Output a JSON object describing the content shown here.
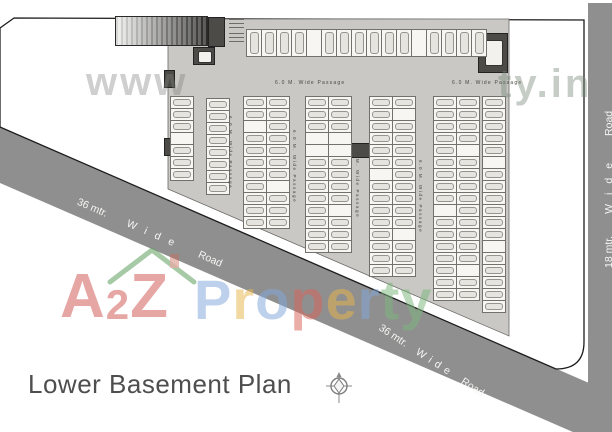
{
  "meta": {
    "plan_title": "Lower Basement Plan"
  },
  "watermarks": {
    "url_prefix": "www",
    "url_suffix": "ty.in",
    "brand": {
      "a2z": [
        {
          "ch": "A",
          "color": "#d15552",
          "size": "big"
        },
        {
          "ch": "2",
          "color": "#d15552",
          "size": "small"
        },
        {
          "ch": "Z",
          "color": "#d15552",
          "size": "big"
        }
      ],
      "property": [
        {
          "ch": "P",
          "color": "#84a9dc"
        },
        {
          "ch": "r",
          "color": "#e8b64c"
        },
        {
          "ch": "o",
          "color": "#84a9dc"
        },
        {
          "ch": "p",
          "color": "#d96459"
        },
        {
          "ch": "e",
          "color": "#e8b64c"
        },
        {
          "ch": "r",
          "color": "#84a9dc"
        },
        {
          "ch": "t",
          "color": "#7cb87c"
        },
        {
          "ch": "y",
          "color": "#7cb87c"
        }
      ]
    }
  },
  "roads": {
    "color": "#8f8f8f",
    "diagonal": {
      "label": {
        "dim": "36 mtr.",
        "wide": "Wide",
        "road": "Road"
      }
    },
    "right": {
      "label": {
        "dim": "18 mtr.",
        "wide": "Wide",
        "road": "Road"
      }
    }
  },
  "plan": {
    "fill": "#c9c8c4",
    "passages_top": [
      {
        "x": 275,
        "y": 80,
        "text": "6.0 M. Wide Passage"
      },
      {
        "x": 452,
        "y": 80,
        "text": "6.0 M. Wide Passage"
      }
    ],
    "passages_vertical": [
      {
        "x": 233,
        "y": 116,
        "text": "6.0 M. Wide Passage"
      },
      {
        "x": 297,
        "y": 130,
        "text": "6.0 M. Wide Passage"
      },
      {
        "x": 360,
        "y": 145,
        "text": "6.0 M. Wide Passage"
      },
      {
        "x": 423,
        "y": 160,
        "text": "6.0 M. Wide Passage"
      }
    ],
    "structures": [
      {
        "name": "entry-ramp",
        "type": "ramp",
        "x": 115,
        "y": 16,
        "w": 93,
        "h": 30
      },
      {
        "name": "core-block",
        "type": "solid",
        "x": 208,
        "y": 17,
        "w": 17,
        "h": 30
      },
      {
        "name": "ramp-note-1",
        "type": "notes",
        "x": 229,
        "y": 19,
        "w": 15,
        "h": 10
      },
      {
        "name": "ramp-note-2",
        "type": "notes",
        "x": 229,
        "y": 33,
        "w": 15,
        "h": 10
      },
      {
        "name": "lift-top-left",
        "type": "lift",
        "x": 193,
        "y": 47,
        "w": 22,
        "h": 18
      },
      {
        "name": "stair-top-right",
        "type": "lift",
        "x": 478,
        "y": 33,
        "w": 30,
        "h": 40
      },
      {
        "name": "central-core",
        "type": "solid",
        "x": 328,
        "y": 143,
        "w": 44,
        "h": 15
      },
      {
        "name": "edge-block-1",
        "type": "solid",
        "x": 164,
        "y": 70,
        "w": 11,
        "h": 18
      },
      {
        "name": "edge-block-2",
        "type": "solid",
        "x": 164,
        "y": 138,
        "w": 11,
        "h": 18
      }
    ],
    "parking": {
      "stall_w": 24,
      "stall_h": 13,
      "top_row": {
        "x": 246,
        "y": 29,
        "count": 16,
        "stall_w": 16,
        "stall_h": 28,
        "empty": [
          4,
          11
        ]
      },
      "columns": [
        {
          "x": 170,
          "y": 96,
          "rows": 7,
          "cols": 1,
          "empty": [
            [
              3
            ]
          ]
        },
        {
          "x": 206,
          "y": 98,
          "rows": 8,
          "cols": 1,
          "empty": [
            []
          ]
        },
        {
          "x": 243,
          "y": 96,
          "rows": 11,
          "cols": 2,
          "empty": [
            [
              2
            ],
            [
              7
            ]
          ]
        },
        {
          "x": 305,
          "y": 96,
          "rows": 13,
          "cols": 2,
          "empty": [
            [
              3,
              4
            ],
            [
              3,
              4,
              9
            ]
          ]
        },
        {
          "x": 369,
          "y": 96,
          "rows": 15,
          "cols": 2,
          "empty": [
            [
              6
            ],
            [
              1,
              11
            ]
          ]
        },
        {
          "x": 433,
          "y": 96,
          "rows": 17,
          "cols": 2,
          "empty": [
            [
              9
            ],
            [
              4,
              14
            ]
          ]
        },
        {
          "x": 482,
          "y": 96,
          "rows": 18,
          "cols": 1,
          "empty": [
            [
              5,
              12
            ]
          ]
        }
      ]
    }
  }
}
